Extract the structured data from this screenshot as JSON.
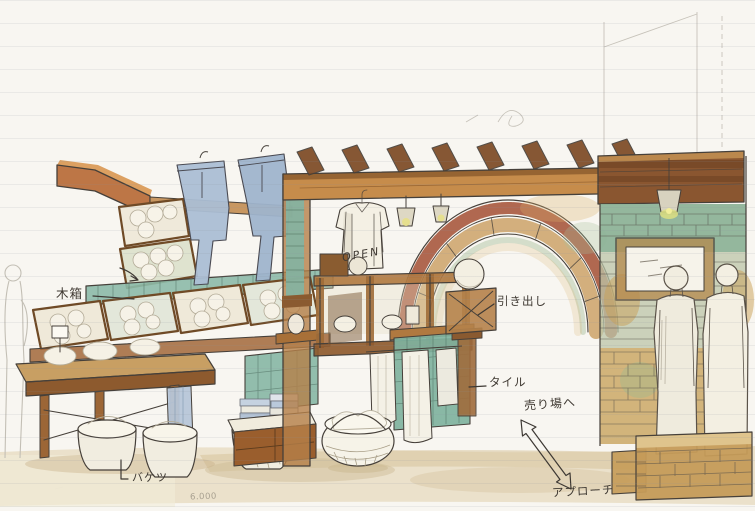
{
  "artwork": {
    "open_sign": "OPEN"
  },
  "annotations": {
    "wooden_box": "木箱",
    "drawer": "引き出し",
    "tile": "タイル",
    "to_sales_floor": "売り場へ",
    "bucket": "バケツ",
    "approach": "アプローチ",
    "dimension_note": "6.000"
  },
  "palette": {
    "paper": "#f8f6f1",
    "ink": "#46403a",
    "wood": "#b5713a",
    "wood_dark": "#8a5630",
    "brick_red": "#a04c30",
    "tile_teal": "#85b5a2",
    "denim_blue": "#a9bdd3",
    "wash_tan": "#c9a055",
    "glow_yellow": "#dde183",
    "floor_beige": "#e8ddc4"
  }
}
